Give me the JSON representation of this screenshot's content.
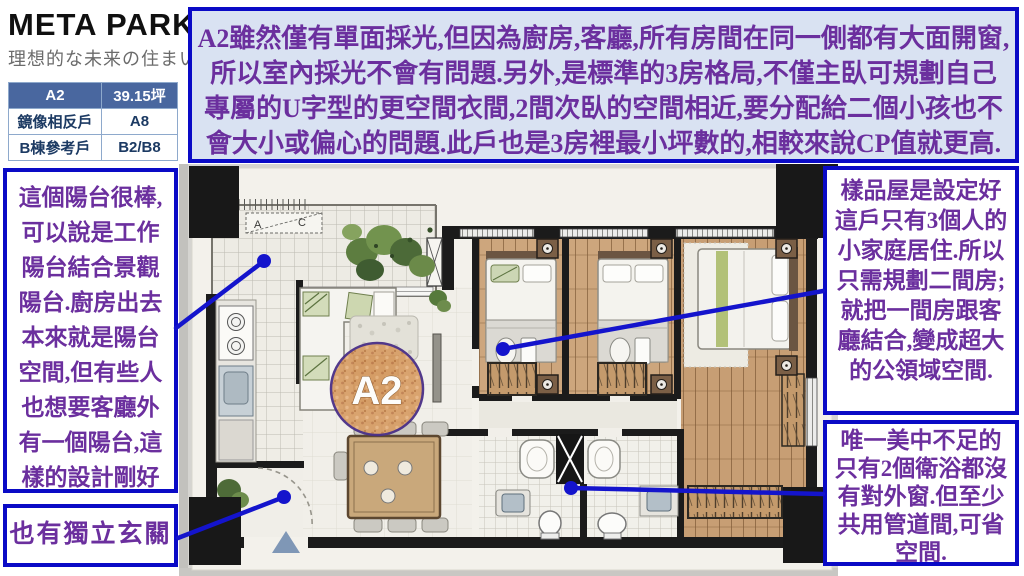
{
  "logo": {
    "brand": "META PARK",
    "tagline": "理想的な未来の住まい"
  },
  "unit_table": {
    "header": {
      "unit": "A2",
      "area": "39.15坪"
    },
    "rows": [
      {
        "label": "鏡像相反戶",
        "value": "A8"
      },
      {
        "label": "B棟參考戶",
        "value": "B2/B8"
      }
    ]
  },
  "notes": {
    "top": {
      "lines": [
        "A2雖然僅有單面採光,但因為廚房,客廳,所有房間在同一側都有大面開窗,",
        "所以室內採光不會有問題.另外,是標準的3房格局,不僅主臥可規劃自己",
        "專屬的U字型的更空間衣間,2間次臥的空間相近,要分配給二個小孩也不",
        "會大小或偏心的問題.此戶也是3房裡最小坪數的,相較來說CP值就更高."
      ]
    },
    "left_balcony": "這個陽台很棒,可以說是工作陽台結合景觀陽台.廚房出去本來就是陽台空間,但有些人也想要客廳外有一個陽台,這樣的設計剛好能滿足.",
    "left_entry": "也有獨立玄關",
    "right_sample": "樣品屋是設定好這戶只有3個人的小家庭居住.所以只需規劃二間房;就把一間房跟客廳結合,變成超大的公領域空間.",
    "right_bath": "唯一美中不足的只有2個衛浴都沒有對外窗.但至少共用管道間,可省空間."
  },
  "floorplan": {
    "unit_label": "A2",
    "marker_a": "A",
    "marker_c": "C"
  },
  "colors": {
    "note_border": "#0a0ac6",
    "note_text": "#6b2f9e",
    "top_note_bg": "#d9e2f2",
    "table_header_bg": "#49679f",
    "annotation_line": "#1414cc",
    "unit_circle_fill": "#d89a62",
    "unit_circle_ring": "#4a2f86"
  }
}
